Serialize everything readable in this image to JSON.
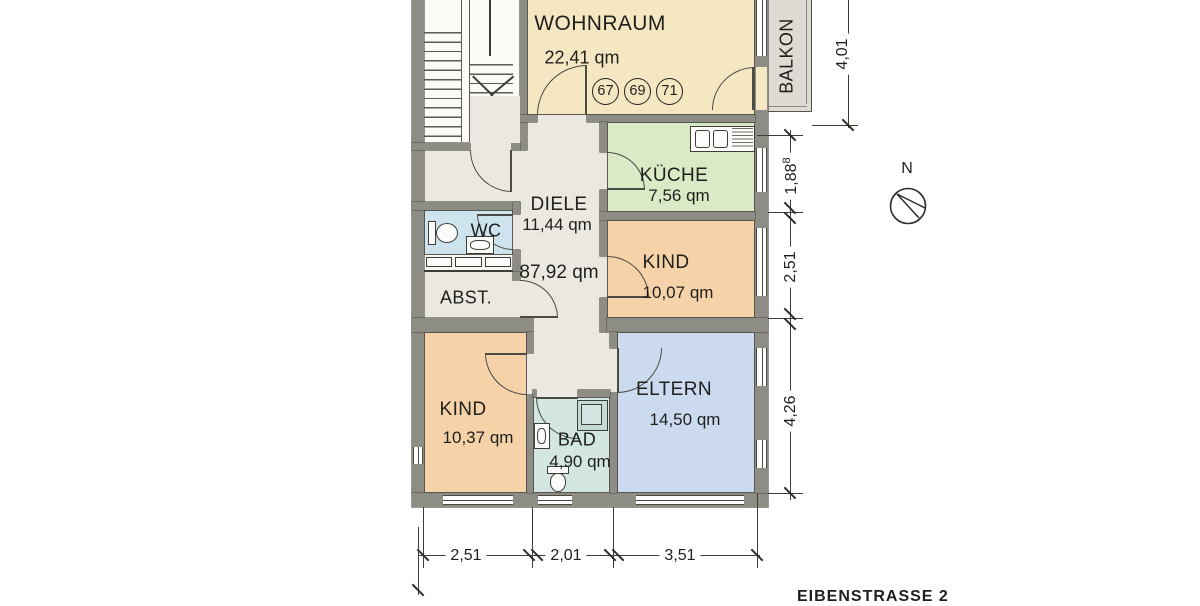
{
  "plan": {
    "street_label": "EIBENSTRASSE 2",
    "total_area": "87,92 qm",
    "compass": {
      "north": "N"
    },
    "unit_numbers": [
      "67",
      "69",
      "71"
    ],
    "rooms": {
      "wohnraum": {
        "label": "WOHNRAUM",
        "area": "22,41 qm"
      },
      "kueche": {
        "label": "KÜCHE",
        "area": "7,56 qm"
      },
      "diele": {
        "label": "DIELE",
        "area": "11,44 qm"
      },
      "wc": {
        "label": "WC"
      },
      "abst": {
        "label": "ABST."
      },
      "kind_right": {
        "label": "KIND",
        "area": "10,07 qm"
      },
      "kind_left": {
        "label": "KIND",
        "area": "10,37 qm"
      },
      "bad": {
        "label": "BAD",
        "area": "4,90 qm"
      },
      "eltern": {
        "label": "ELTERN",
        "area": "14,50 qm"
      },
      "balkon": {
        "label": "BALKON"
      }
    },
    "dimensions": {
      "bottom": [
        "2,51",
        "2,01",
        "3,51"
      ],
      "right_top": "1,88",
      "right_top_sup": "8",
      "right_mid": "2,51",
      "right_bottom": "4,26",
      "balcony": "4,01"
    },
    "colors": {
      "wall": "#8d8c85",
      "floor": "#ebe8e1",
      "wohnraum": "#f6e7c3",
      "kueche": "#dbeac6",
      "kind": "#f6d2a9",
      "eltern": "#cbdaee",
      "bad": "#d3e6e2",
      "wc": "#cde4ef",
      "balkon": "#dedbd4"
    }
  }
}
